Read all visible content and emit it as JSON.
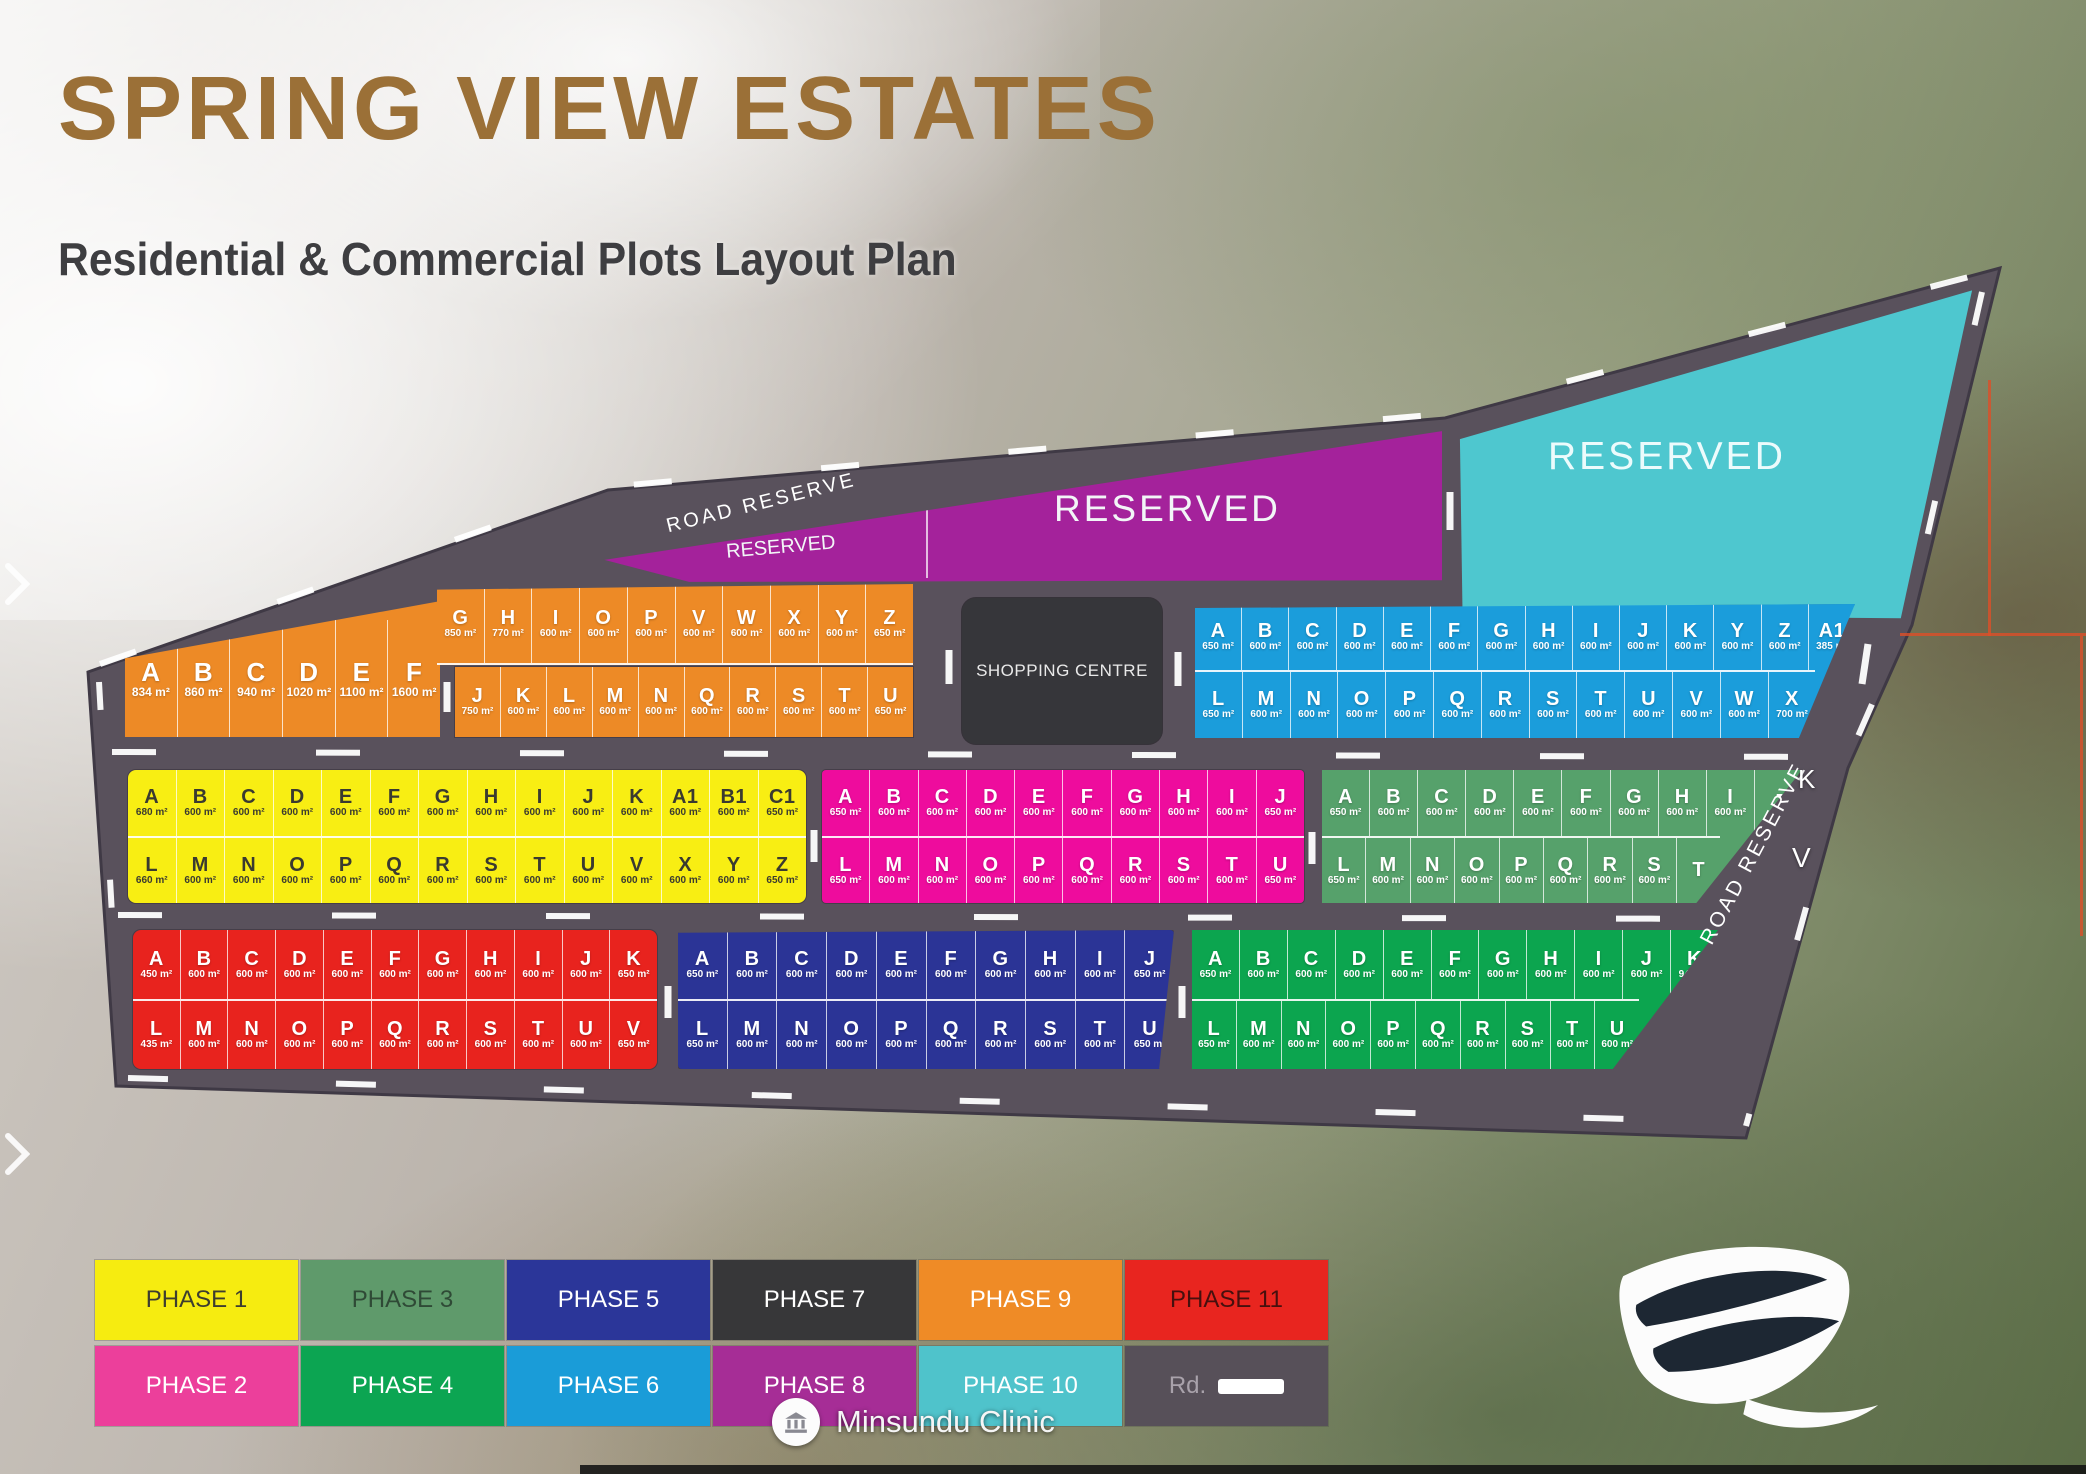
{
  "title": "SPRING VIEW ESTATES",
  "subtitle": "Residential & Commercial Plots Layout Plan",
  "labels": {
    "road_reserve_top": "ROAD RESERVE",
    "road_reserve_right": "ROAD RESERVE",
    "reserved_wedge": "RESERVED",
    "reserved_purple": "RESERVED",
    "reserved_cyan": "RESERVED",
    "shopping_centre": "SHOPPING CENTRE",
    "clinic": "Minsundu Clinic",
    "stray_k": "K",
    "stray_v": "V"
  },
  "colors": {
    "road": "#59515C",
    "reserved_purple": "#A4229B",
    "reserved_cyan": "#4EC7CF",
    "shopping": "#36363A",
    "title": "#9B7037"
  },
  "blocks": [
    {
      "id": "phase9-left",
      "phase": "PHASE 9",
      "color": "#ED8A26",
      "text": "light",
      "rows": [
        [
          [
            "A",
            "834 m²"
          ],
          [
            "B",
            "860 m²"
          ],
          [
            "C",
            "940 m²"
          ],
          [
            "D",
            "1020 m²"
          ],
          [
            "E",
            "1100 m²"
          ],
          [
            "F",
            "1600 m²"
          ]
        ]
      ]
    },
    {
      "id": "phase9-top",
      "phase": "PHASE 9",
      "color": "#ED8A26",
      "text": "light",
      "rows": [
        [
          [
            "G",
            "850 m²"
          ],
          [
            "H",
            "770 m²"
          ],
          [
            "I",
            "600 m²"
          ],
          [
            "O",
            "600 m²"
          ],
          [
            "P",
            "600 m²"
          ],
          [
            "V",
            "600 m²"
          ],
          [
            "W",
            "600 m²"
          ],
          [
            "X",
            "600 m²"
          ],
          [
            "Y",
            "600 m²"
          ],
          [
            "Z",
            "650 m²"
          ]
        ]
      ]
    },
    {
      "id": "phase9-bottom",
      "phase": "PHASE 9",
      "color": "#ED8A26",
      "text": "light",
      "rows": [
        [
          [
            "J",
            "750 m²"
          ],
          [
            "K",
            "600 m²"
          ],
          [
            "L",
            "600 m²"
          ],
          [
            "M",
            "600 m²"
          ],
          [
            "N",
            "600 m²"
          ],
          [
            "Q",
            "600 m²"
          ],
          [
            "R",
            "600 m²"
          ],
          [
            "S",
            "600 m²"
          ],
          [
            "T",
            "600 m²"
          ],
          [
            "U",
            "650 m²"
          ]
        ]
      ]
    },
    {
      "id": "phase6",
      "phase": "PHASE 6",
      "color": "#1B9DDB",
      "text": "light",
      "rows": [
        [
          [
            "A",
            "650 m²"
          ],
          [
            "B",
            "600 m²"
          ],
          [
            "C",
            "600 m²"
          ],
          [
            "D",
            "600 m²"
          ],
          [
            "E",
            "600 m²"
          ],
          [
            "F",
            "600 m²"
          ],
          [
            "G",
            "600 m²"
          ],
          [
            "H",
            "600 m²"
          ],
          [
            "I",
            "600 m²"
          ],
          [
            "J",
            "600 m²"
          ],
          [
            "K",
            "600 m²"
          ],
          [
            "Y",
            "600 m²"
          ],
          [
            "Z",
            "600 m²"
          ],
          [
            "A1",
            "385 m²"
          ]
        ],
        [
          [
            "L",
            "650 m²"
          ],
          [
            "M",
            "600 m²"
          ],
          [
            "N",
            "600 m²"
          ],
          [
            "O",
            "600 m²"
          ],
          [
            "P",
            "600 m²"
          ],
          [
            "Q",
            "600 m²"
          ],
          [
            "R",
            "600 m²"
          ],
          [
            "S",
            "600 m²"
          ],
          [
            "T",
            "600 m²"
          ],
          [
            "U",
            "600 m²"
          ],
          [
            "V",
            "600 m²"
          ],
          [
            "W",
            "600 m²"
          ],
          [
            "X",
            "700 m²"
          ]
        ]
      ]
    },
    {
      "id": "phase1",
      "phase": "PHASE 1",
      "color": "#F8EE13",
      "text": "dark",
      "rows": [
        [
          [
            "A",
            "680 m²"
          ],
          [
            "B",
            "600 m²"
          ],
          [
            "C",
            "600 m²"
          ],
          [
            "D",
            "600 m²"
          ],
          [
            "E",
            "600 m²"
          ],
          [
            "F",
            "600 m²"
          ],
          [
            "G",
            "600 m²"
          ],
          [
            "H",
            "600 m²"
          ],
          [
            "I",
            "600 m²"
          ],
          [
            "J",
            "600 m²"
          ],
          [
            "K",
            "600 m²"
          ],
          [
            "A1",
            "600 m²"
          ],
          [
            "B1",
            "600 m²"
          ],
          [
            "C1",
            "650 m²"
          ]
        ],
        [
          [
            "L",
            "660 m²"
          ],
          [
            "M",
            "600 m²"
          ],
          [
            "N",
            "600 m²"
          ],
          [
            "O",
            "600 m²"
          ],
          [
            "P",
            "600 m²"
          ],
          [
            "Q",
            "600 m²"
          ],
          [
            "R",
            "600 m²"
          ],
          [
            "S",
            "600 m²"
          ],
          [
            "T",
            "600 m²"
          ],
          [
            "U",
            "600 m²"
          ],
          [
            "V",
            "600 m²"
          ],
          [
            "X",
            "600 m²"
          ],
          [
            "Y",
            "600 m²"
          ],
          [
            "Z",
            "650 m²"
          ]
        ]
      ]
    },
    {
      "id": "phase2",
      "phase": "PHASE 2",
      "color": "#EE0C9D",
      "text": "light",
      "rows": [
        [
          [
            "A",
            "650 m²"
          ],
          [
            "B",
            "600 m²"
          ],
          [
            "C",
            "600 m²"
          ],
          [
            "D",
            "600 m²"
          ],
          [
            "E",
            "600 m²"
          ],
          [
            "F",
            "600 m²"
          ],
          [
            "G",
            "600 m²"
          ],
          [
            "H",
            "600 m²"
          ],
          [
            "I",
            "600 m²"
          ],
          [
            "J",
            "650 m²"
          ]
        ],
        [
          [
            "L",
            "650 m²"
          ],
          [
            "M",
            "600 m²"
          ],
          [
            "N",
            "600 m²"
          ],
          [
            "O",
            "600 m²"
          ],
          [
            "P",
            "600 m²"
          ],
          [
            "Q",
            "600 m²"
          ],
          [
            "R",
            "600 m²"
          ],
          [
            "S",
            "600 m²"
          ],
          [
            "T",
            "600 m²"
          ],
          [
            "U",
            "650 m²"
          ]
        ]
      ]
    },
    {
      "id": "phase3",
      "phase": "PHASE 3",
      "color": "#56A16B",
      "text": "light",
      "rows": [
        [
          [
            "A",
            "650 m²"
          ],
          [
            "B",
            "600 m²"
          ],
          [
            "C",
            "600 m²"
          ],
          [
            "D",
            "600 m²"
          ],
          [
            "E",
            "600 m²"
          ],
          [
            "F",
            "600 m²"
          ],
          [
            "G",
            "600 m²"
          ],
          [
            "H",
            "600 m²"
          ],
          [
            "I",
            "600 m²"
          ],
          [
            "J",
            ""
          ]
        ],
        [
          [
            "L",
            "650 m²"
          ],
          [
            "M",
            "600 m²"
          ],
          [
            "N",
            "600 m²"
          ],
          [
            "O",
            "600 m²"
          ],
          [
            "P",
            "600 m²"
          ],
          [
            "Q",
            "600 m²"
          ],
          [
            "R",
            "600 m²"
          ],
          [
            "S",
            "600 m²"
          ],
          [
            "T",
            ""
          ]
        ]
      ]
    },
    {
      "id": "phase11",
      "phase": "PHASE 11",
      "color": "#E8231E",
      "text": "light",
      "rows": [
        [
          [
            "A",
            "450 m²"
          ],
          [
            "B",
            "600 m²"
          ],
          [
            "C",
            "600 m²"
          ],
          [
            "D",
            "600 m²"
          ],
          [
            "E",
            "600 m²"
          ],
          [
            "F",
            "600 m²"
          ],
          [
            "G",
            "600 m²"
          ],
          [
            "H",
            "600 m²"
          ],
          [
            "I",
            "600 m²"
          ],
          [
            "J",
            "600 m²"
          ],
          [
            "K",
            "650 m²"
          ]
        ],
        [
          [
            "L",
            "435 m²"
          ],
          [
            "M",
            "600 m²"
          ],
          [
            "N",
            "600 m²"
          ],
          [
            "O",
            "600 m²"
          ],
          [
            "P",
            "600 m²"
          ],
          [
            "Q",
            "600 m²"
          ],
          [
            "R",
            "600 m²"
          ],
          [
            "S",
            "600 m²"
          ],
          [
            "T",
            "600 m²"
          ],
          [
            "U",
            "600 m²"
          ],
          [
            "V",
            "650 m²"
          ]
        ]
      ]
    },
    {
      "id": "phase5",
      "phase": "PHASE 5",
      "color": "#2B3496",
      "text": "light",
      "rows": [
        [
          [
            "A",
            "650 m²"
          ],
          [
            "B",
            "600 m²"
          ],
          [
            "C",
            "600 m²"
          ],
          [
            "D",
            "600 m²"
          ],
          [
            "E",
            "600 m²"
          ],
          [
            "F",
            "600 m²"
          ],
          [
            "G",
            "600 m²"
          ],
          [
            "H",
            "600 m²"
          ],
          [
            "I",
            "600 m²"
          ],
          [
            "J",
            "650 m²"
          ]
        ],
        [
          [
            "L",
            "650 m²"
          ],
          [
            "M",
            "600 m²"
          ],
          [
            "N",
            "600 m²"
          ],
          [
            "O",
            "600 m²"
          ],
          [
            "P",
            "600 m²"
          ],
          [
            "Q",
            "600 m²"
          ],
          [
            "R",
            "600 m²"
          ],
          [
            "S",
            "600 m²"
          ],
          [
            "T",
            "600 m²"
          ],
          [
            "U",
            "650 m²"
          ]
        ]
      ]
    },
    {
      "id": "phase4",
      "phase": "PHASE 4",
      "color": "#0CA54F",
      "text": "light",
      "rows": [
        [
          [
            "A",
            "650 m²"
          ],
          [
            "B",
            "600 m²"
          ],
          [
            "C",
            "600 m²"
          ],
          [
            "D",
            "600 m²"
          ],
          [
            "E",
            "600 m²"
          ],
          [
            "F",
            "600 m²"
          ],
          [
            "G",
            "600 m²"
          ],
          [
            "H",
            "600 m²"
          ],
          [
            "I",
            "600 m²"
          ],
          [
            "J",
            "600 m²"
          ],
          [
            "K",
            "940 m²"
          ]
        ],
        [
          [
            "L",
            "650 m²"
          ],
          [
            "M",
            "600 m²"
          ],
          [
            "N",
            "600 m²"
          ],
          [
            "O",
            "600 m²"
          ],
          [
            "P",
            "600 m²"
          ],
          [
            "Q",
            "600 m²"
          ],
          [
            "R",
            "600 m²"
          ],
          [
            "S",
            "600 m²"
          ],
          [
            "T",
            "600 m²"
          ],
          [
            "U",
            "600 m²"
          ]
        ]
      ]
    }
  ],
  "legend": {
    "rows": [
      [
        {
          "label": "PHASE 1",
          "color": "#F6EC10",
          "text": "#3D3D2F"
        },
        {
          "label": "PHASE 3",
          "color": "#5F9A6B",
          "text": "#2F4A36"
        },
        {
          "label": "PHASE 5",
          "color": "#2B3699",
          "text": "#FFFFFF"
        },
        {
          "label": "PHASE 7",
          "color": "#373739",
          "text": "#FFFFFF"
        },
        {
          "label": "PHASE 9",
          "color": "#EF8B26",
          "text": "#FFFFFF"
        },
        {
          "label": "PHASE 11",
          "color": "#E8251F",
          "text": "#46100E"
        }
      ],
      [
        {
          "label": "PHASE 2",
          "color": "#EC3F9B",
          "text": "#FFFFFF"
        },
        {
          "label": "PHASE 4",
          "color": "#0CA552",
          "text": "#FFFFFF"
        },
        {
          "label": "PHASE 6",
          "color": "#1A9CD8",
          "text": "#FFFFFF"
        },
        {
          "label": "PHASE 8",
          "color": "#A62D96",
          "text": "#FFFFFF"
        },
        {
          "label": "PHASE 10",
          "color": "#4FC3CB",
          "text": "#FFFFFF"
        },
        {
          "label": "Rd.",
          "color": "#575059",
          "text": "#A9A2AB",
          "swatch": true
        }
      ]
    ]
  }
}
